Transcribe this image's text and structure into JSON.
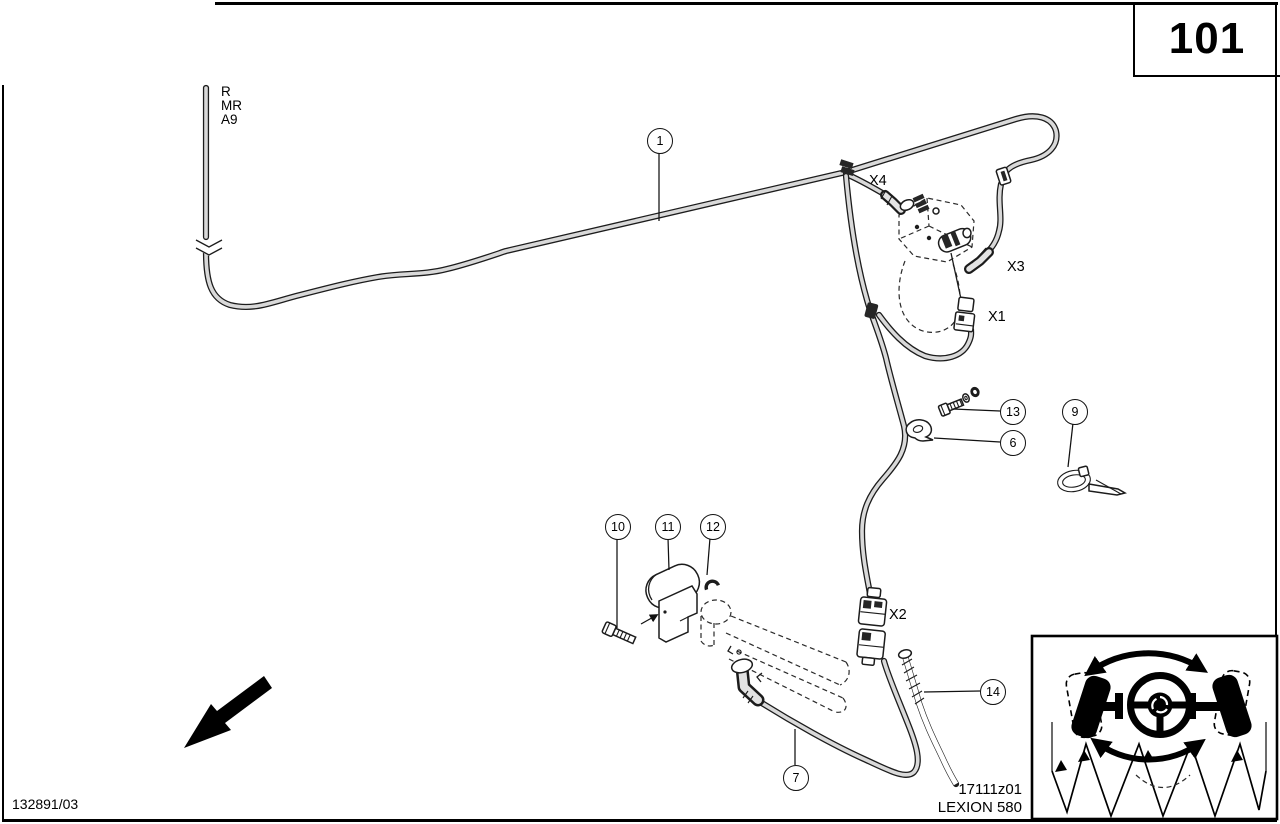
{
  "page": {
    "number": "101",
    "catalog_code": "132891/03",
    "figure_code": "17111z01",
    "model": "LEXION 580"
  },
  "hose_labels": {
    "r": "R",
    "mr": "MR",
    "a9": "A9"
  },
  "connector_labels": {
    "x1": "X1",
    "x2": "X2",
    "x3": "X3",
    "x4": "X4"
  },
  "callouts": {
    "c1": "1",
    "c6": "6",
    "c7": "7",
    "c9": "9",
    "c10": "10",
    "c11": "11",
    "c12": "12",
    "c13": "13",
    "c14": "14"
  },
  "icons": {
    "travel_direction_arrow": "bold-arrow-down-left",
    "hose_break_symbol": "double-chevron-break",
    "steering_inset": "steering-wheel-with-pivoting-wheels-over-corn-header"
  }
}
